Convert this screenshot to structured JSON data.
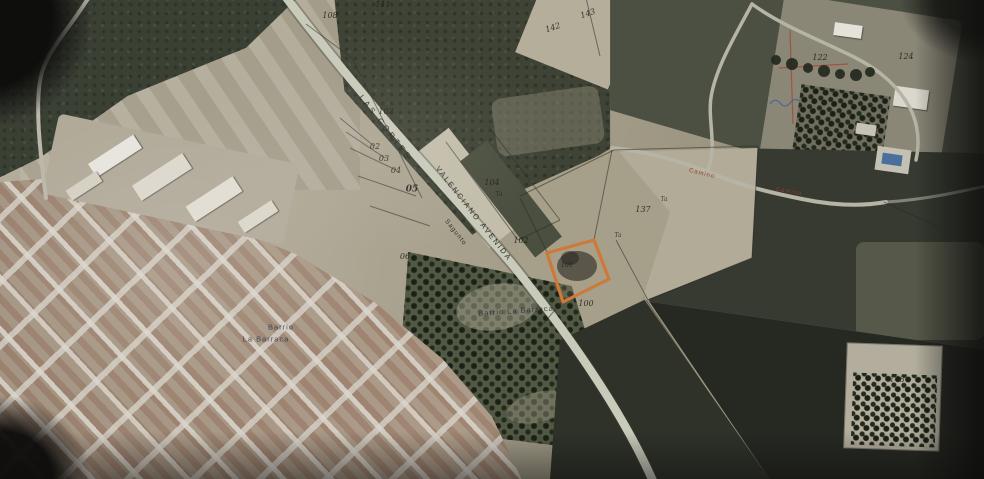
{
  "image": {
    "kind_note": "photograph of a printed aerial cadastral map with one parcel highlighted in orange",
    "width": 984,
    "height": 479
  },
  "colors": {
    "highlight_orange": "#df7421",
    "camino_red": "#a33426",
    "road_light": "#caccb8",
    "map_ink": "#1c1c14",
    "district_ink": "#1c2640",
    "pool_blue": "#3e6fa6"
  },
  "labels": {
    "streets": [
      {
        "text": "LAS CORTES"
      },
      {
        "text": "VALENCIANO"
      },
      {
        "text": "AVENIDA"
      },
      {
        "text": "Sagunto"
      }
    ],
    "roads_red": [
      {
        "text": "Camino"
      },
      {
        "text": "Camino"
      }
    ],
    "districts": [
      {
        "text": "Barrio"
      },
      {
        "text": "La Barraca"
      },
      {
        "text": "Barrio La Barraca"
      }
    ],
    "parcels": [
      {
        "text": "111"
      },
      {
        "text": "108"
      },
      {
        "text": "142"
      },
      {
        "text": "143"
      },
      {
        "text": "122"
      },
      {
        "text": "124"
      },
      {
        "text": "103"
      },
      {
        "text": "02"
      },
      {
        "text": "03"
      },
      {
        "text": "04"
      },
      {
        "text": "05"
      },
      {
        "text": "06"
      },
      {
        "text": "104"
      },
      {
        "text": "102"
      },
      {
        "text": "101"
      },
      {
        "text": "100"
      },
      {
        "text": "137"
      },
      {
        "text": "148"
      }
    ],
    "ta_marks": [
      {
        "text": "Ta"
      },
      {
        "text": "Ta"
      },
      {
        "text": "Ta"
      }
    ]
  },
  "highlight": {
    "parcel_label": "101",
    "outline_color": "#df7421"
  }
}
